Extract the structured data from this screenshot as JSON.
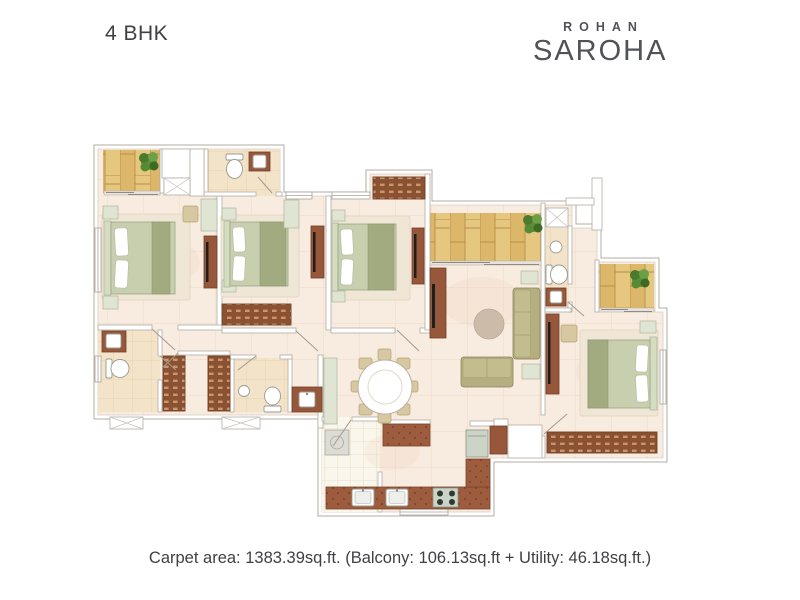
{
  "header": {
    "title": "4 BHK"
  },
  "brand": {
    "line1": "ROHAN",
    "line2": "SAROHA"
  },
  "caption": "Carpet area: 1383.39sq.ft. (Balcony: 106.13sq.ft + Utility: 46.18sq.ft.)",
  "plan": {
    "unit_type": "4 BHK",
    "carpet_area_sqft": "1383.39",
    "balcony_area_sqft": "106.13",
    "utility_area_sqft": "46.18"
  },
  "palette": {
    "text": "#3f4044",
    "brand": "#515257",
    "floor": "#f8ebdf",
    "bath-floor": "#f3e4c9",
    "wood": "#dcb76a",
    "counter": "#9c5c3d",
    "wardrobe": "#8b5133",
    "bed-green": "#c8cfae",
    "sofa": "#b5ae81",
    "plant": "#5d8f3a",
    "wall-line": "#b3aca3",
    "background": "#ffffff"
  }
}
